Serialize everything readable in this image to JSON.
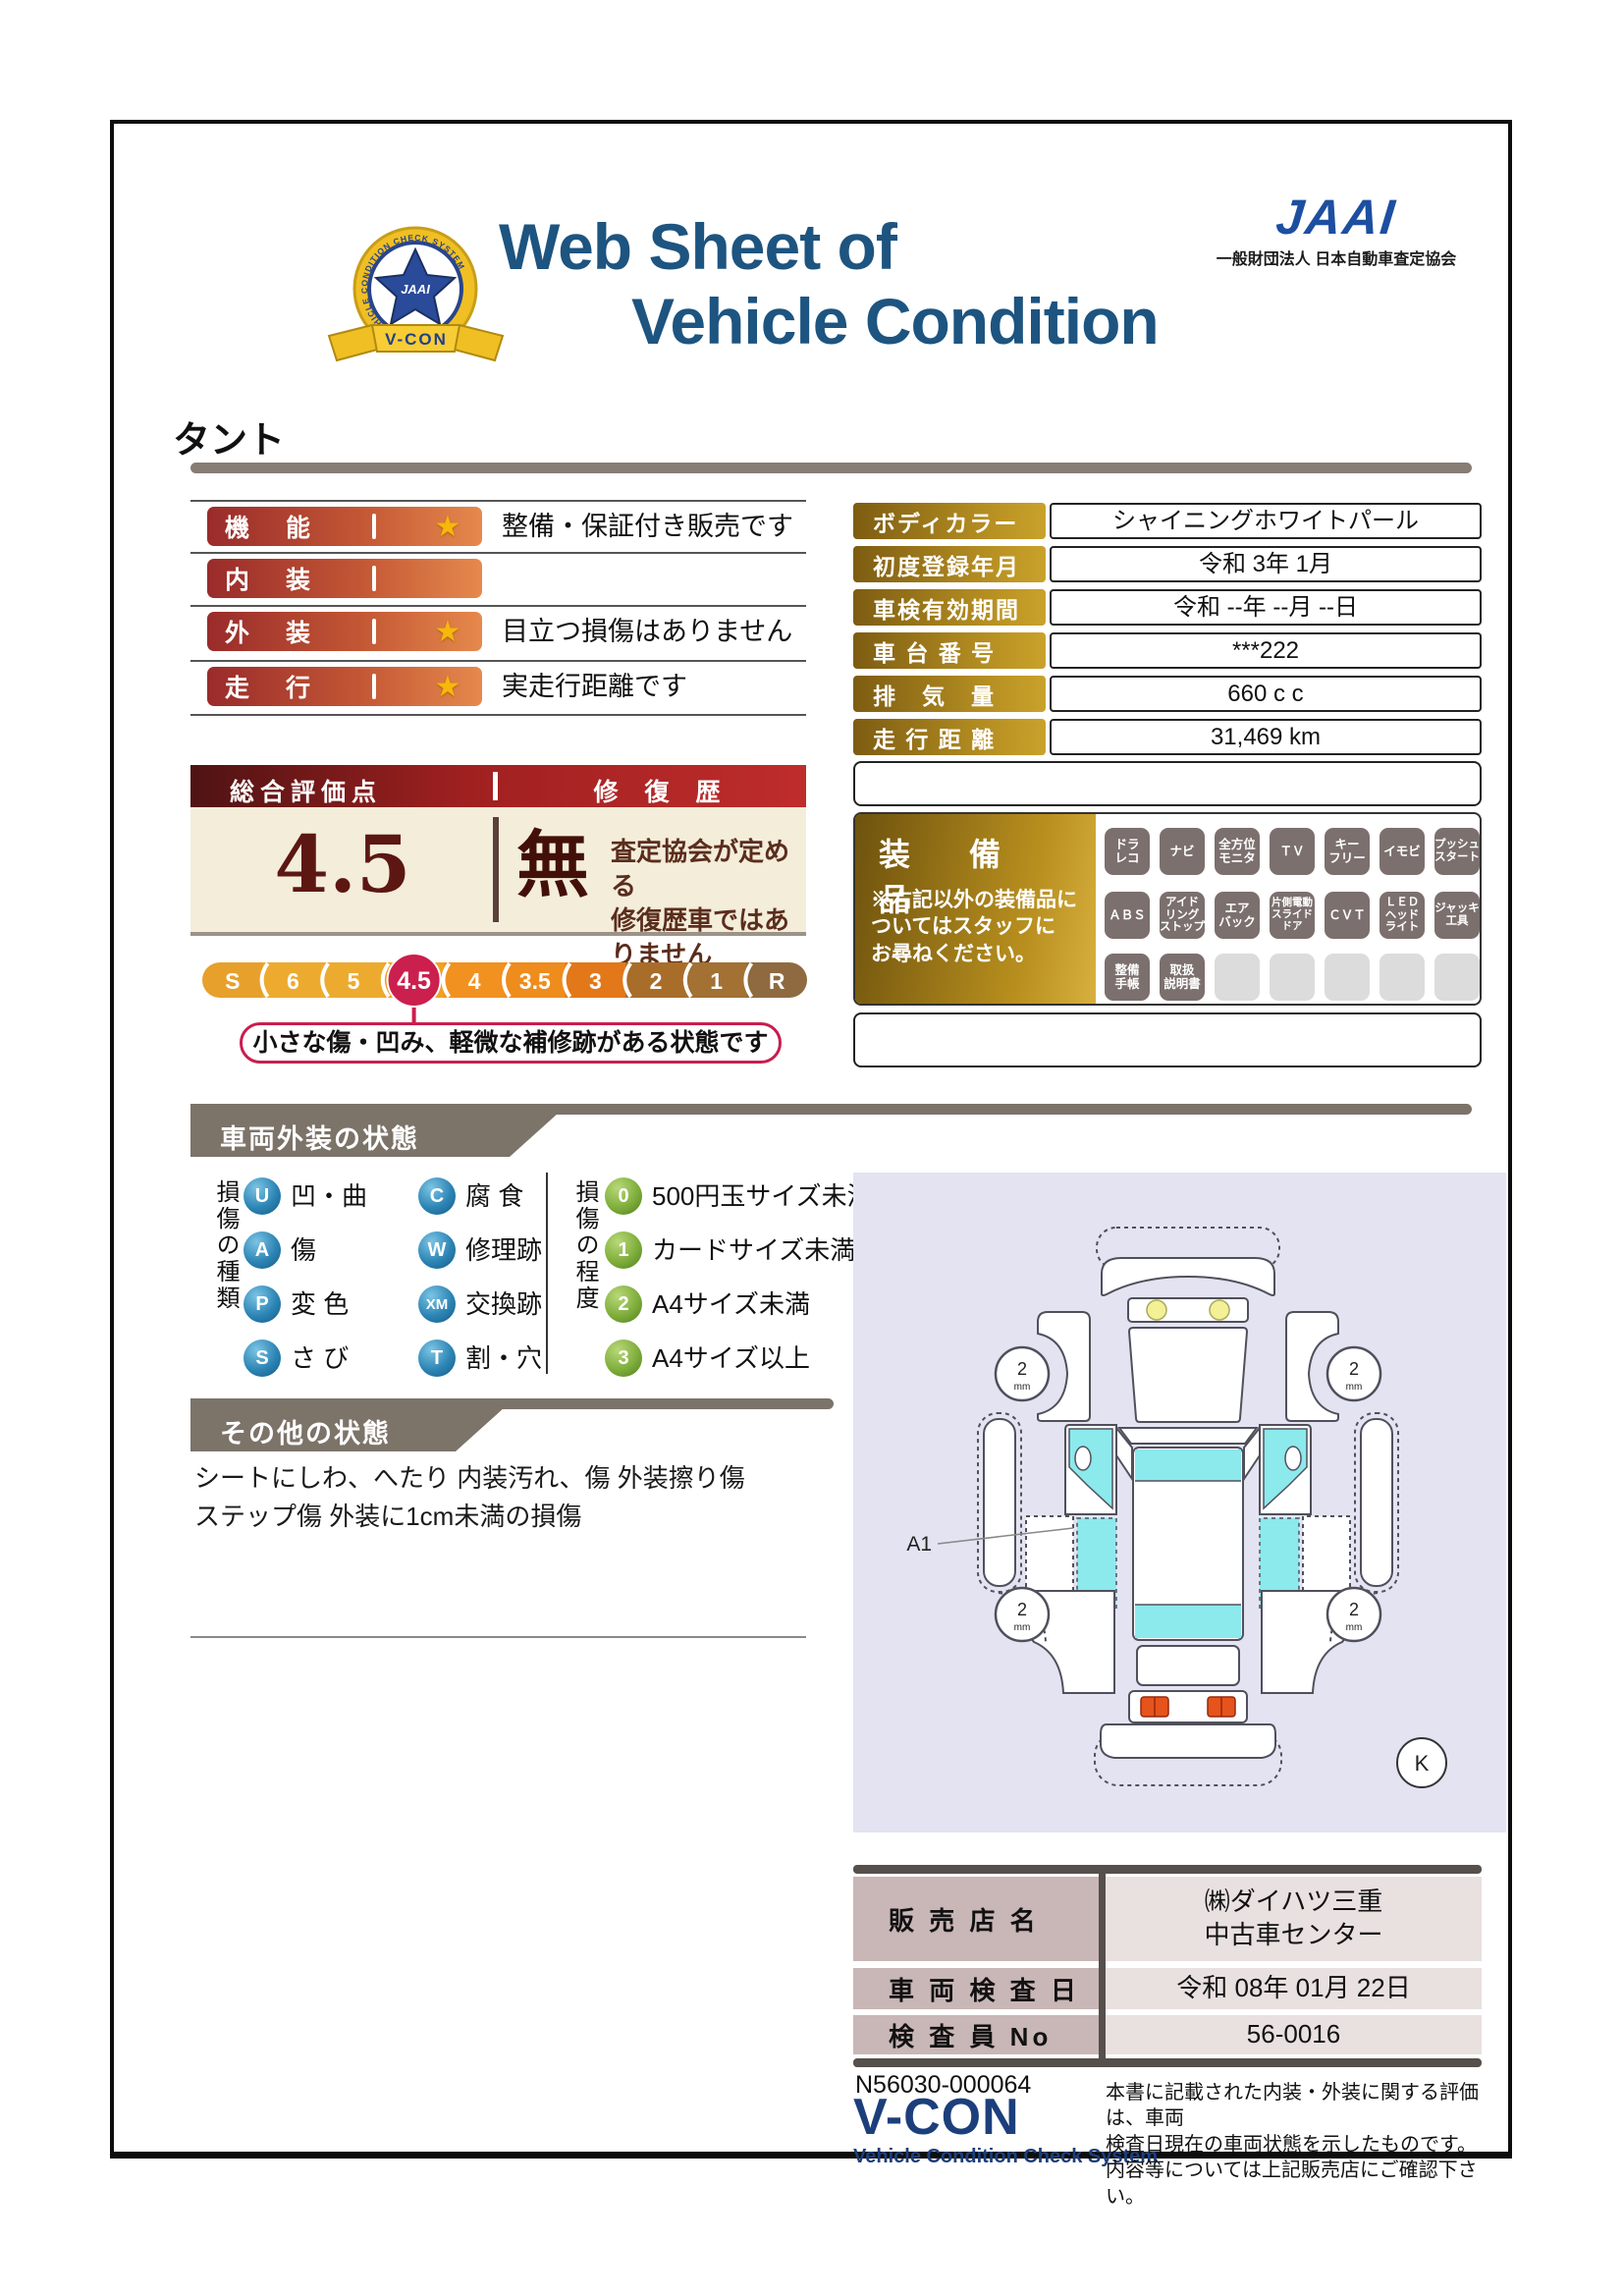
{
  "page": {
    "emblem": {
      "center_text": "JAAI",
      "ring_text": "VEHICLE CONDITION CHECK SYSTEM",
      "ribbon_text": "V-CON"
    },
    "title_line1": "Web Sheet of",
    "title_line2": "Vehicle Condition",
    "jaai_logo_text": "JAAI",
    "jaai_subtitle": "一般財団法人 日本自動車査定協会",
    "vehicle_name": "タント"
  },
  "ratings": {
    "rows": [
      {
        "label": "機　能",
        "star": "★",
        "comment": "整備・保証付き販売です"
      },
      {
        "label": "内　装",
        "star": "",
        "comment": ""
      },
      {
        "label": "外　装",
        "star": "★",
        "comment": "目立つ損傷はありません"
      },
      {
        "label": "走　行",
        "star": "★",
        "comment": "実走行距離です"
      }
    ]
  },
  "info_table": {
    "rows": [
      {
        "label": "ボディカラー",
        "value": "シャイニングホワイトパール"
      },
      {
        "label": "初度登録年月",
        "value": "令和 3年 1月"
      },
      {
        "label": "車検有効期間",
        "value": "令和 --年 --月 --日"
      },
      {
        "label": "車 台 番 号",
        "value": "***222"
      },
      {
        "label": "排　気　量",
        "value": "660 c c"
      },
      {
        "label": "走 行 距 離",
        "value": "31,469 km"
      }
    ]
  },
  "overall": {
    "header_left": "総合評価点",
    "header_right": "修 復 歴",
    "score": "4.5",
    "repair_flag": "無",
    "repair_note": "査定協会が定める\n修復歴車ではありません",
    "scale": [
      "S",
      "6",
      "5",
      "4.5",
      "4",
      "3.5",
      "3",
      "2",
      "1",
      "R"
    ],
    "scale_selected": "4.5",
    "callout": "小さな傷・凹み、軽微な補修跡がある状態です"
  },
  "equipment": {
    "title": "装　備　品",
    "note": "※右記以外の装備品に\nついてはスタッフに\nお尋ねください。",
    "badges": [
      "ドラ\nレコ",
      "ナビ",
      "全方位\nモニタ",
      "ＴＶ",
      "キー\nフリー",
      "イモビ",
      "プッシュ\nスタート",
      "ＡＢＳ",
      "アイド\nリング\nストップ",
      "エア\nバック",
      "片側電動\nスライド\nドア",
      "ＣＶＴ",
      "ＬＥＤ\nヘッド\nライト",
      "ジャッキ\n工具",
      "整備\n手帳",
      "取扱\n説明書"
    ]
  },
  "exterior": {
    "banner": "車両外装の状態",
    "types_label": "損傷の種類",
    "types": [
      {
        "code": "U",
        "label": "凹・曲"
      },
      {
        "code": "C",
        "label": "腐 食"
      },
      {
        "code": "A",
        "label": "傷"
      },
      {
        "code": "W",
        "label": "修理跡"
      },
      {
        "code": "P",
        "label": "変 色"
      },
      {
        "code": "XM",
        "label": "交換跡"
      },
      {
        "code": "S",
        "label": "さ び"
      },
      {
        "code": "T",
        "label": "割・穴"
      }
    ],
    "levels_label": "損傷の程度",
    "levels": [
      {
        "code": "0",
        "label": "500円玉サイズ未満"
      },
      {
        "code": "1",
        "label": "カードサイズ未満"
      },
      {
        "code": "2",
        "label": "A4サイズ未満"
      },
      {
        "code": "3",
        "label": "A4サイズ以上"
      }
    ],
    "diagram": {
      "marker": "A1",
      "tread_value": "2",
      "tread_unit": "mm",
      "corner_mark": "K"
    }
  },
  "other_status": {
    "banner": "その他の状態",
    "text": "シートにしわ、へたり 内装汚れ、傷 外装擦り傷\nステップ傷 外装に1cm未満の損傷"
  },
  "dealer": {
    "rows": [
      {
        "label": "販 売 店 名",
        "value": "㈱ダイハツ三重\n中古車センター"
      },
      {
        "label": "車 両 検 査 日",
        "value": "令和 08年 01月 22日"
      },
      {
        "label": "検 査 員 No",
        "value": "56-0016"
      }
    ]
  },
  "footer": {
    "serial": "N56030-000064",
    "vcon": "V-CON",
    "vcon_sub": "Vehicle Condition Check System",
    "note": "本書に記載された内装・外装に関する評価は、車両\n検査日現在の車両状態を示したものです。\n内容等については上記販売店にご確認下さい。"
  },
  "colors": {
    "title_blue": "#1d5480",
    "jaai_blue": "#1d4fa1",
    "crimson": "#cb1f4e",
    "gold": "#c9a22b",
    "maroon": "#5c1712",
    "banner_gray": "#7c7369",
    "lavender": "#e3e3f2",
    "window_cyan": "#8ce9ec"
  }
}
